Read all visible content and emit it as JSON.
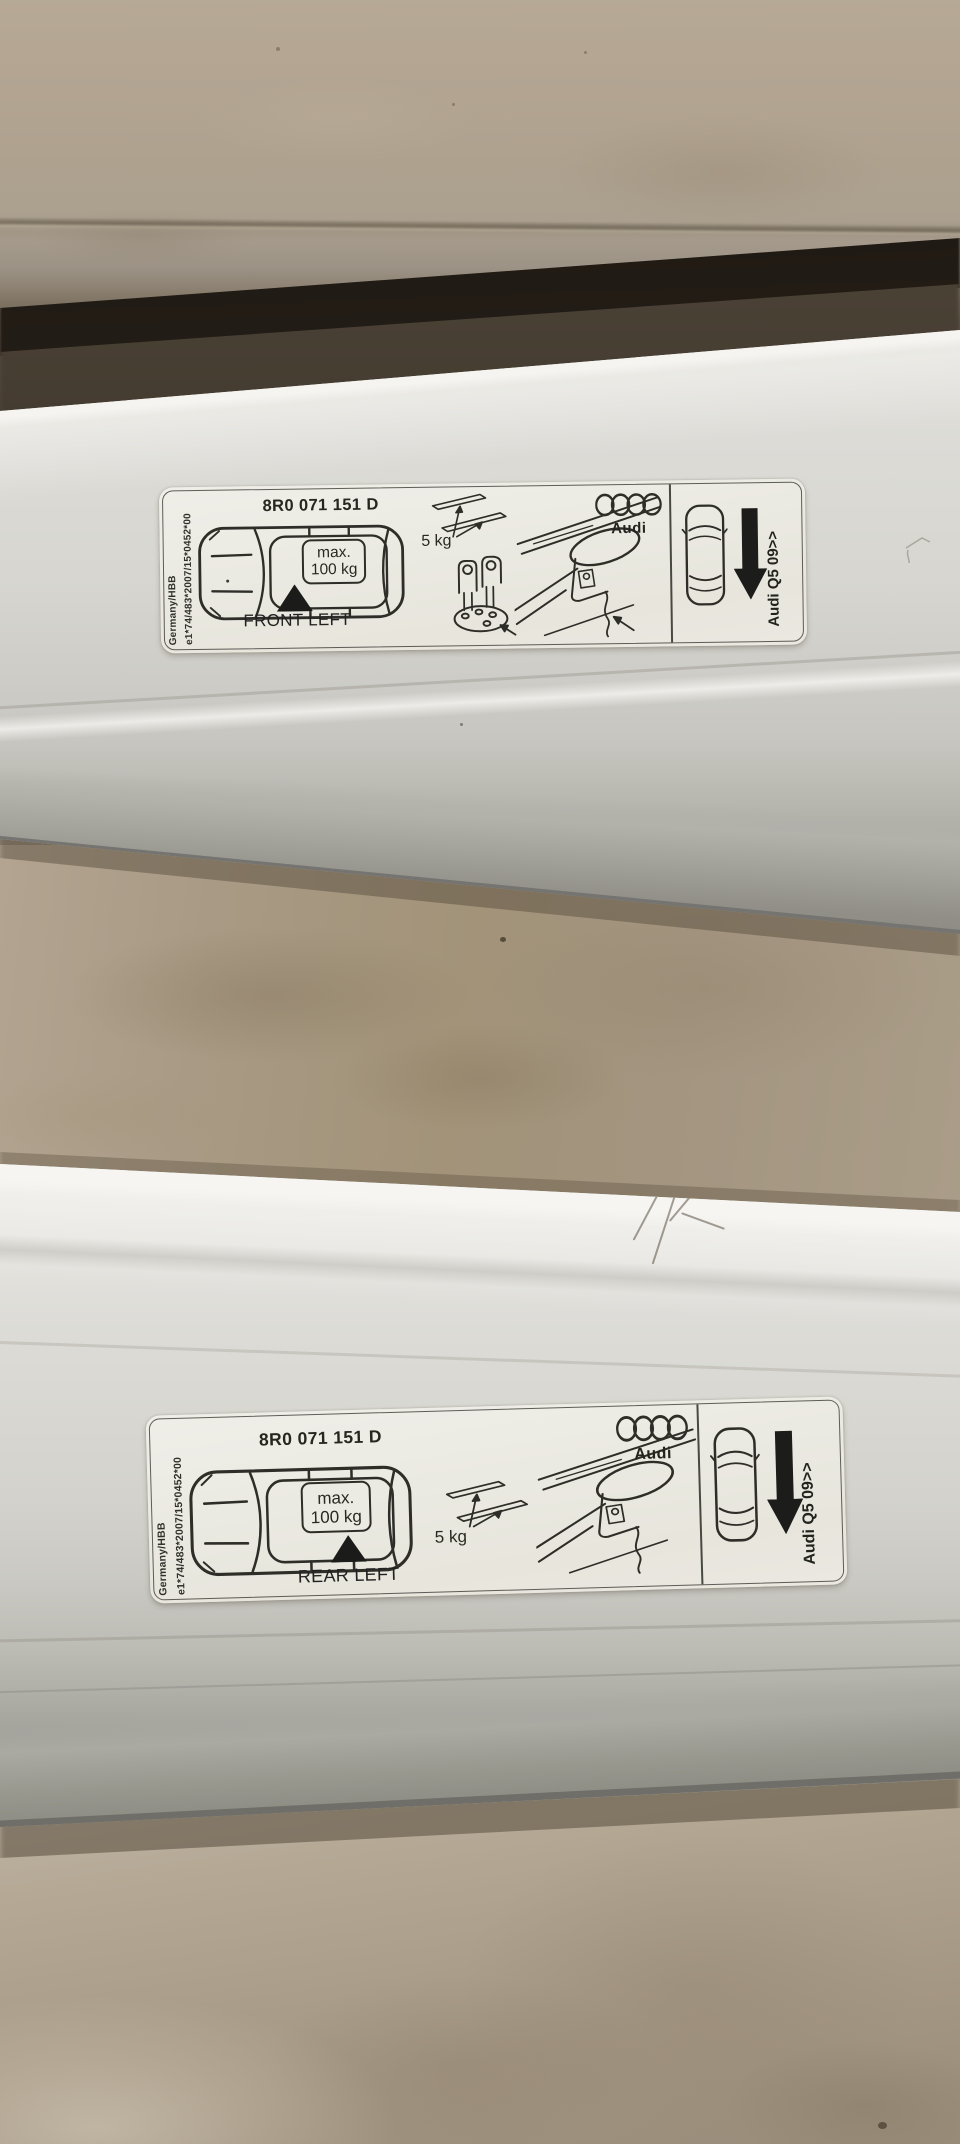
{
  "labels": [
    {
      "part_number": "8R0 071 151 D",
      "fitment_position": "FRONT LEFT",
      "max_load_line1": "max.",
      "max_load_line2": "100 kg",
      "accessory_weight": "5 kg",
      "brand_wordmark": "Audi",
      "vehicle_model": "Audi Q5 09>>",
      "homologation_line1": "Germany/HBB",
      "homologation_line2": "e1*74/483*2007/15*0452*00"
    },
    {
      "part_number": "8R0 071 151 D",
      "fitment_position": "REAR LEFT",
      "max_load_line1": "max.",
      "max_load_line2": "100 kg",
      "accessory_weight": "5 kg",
      "brand_wordmark": "Audi",
      "vehicle_model": "Audi Q5 09>>",
      "homologation_line1": "Germany/HBB",
      "homologation_line2": "e1*74/483*2007/15*0452*00"
    }
  ],
  "icons": {
    "audi_rings": "four-interlocked-circles",
    "direction_arrow": "solid-down-arrow",
    "position_marker": "solid-up-triangle",
    "car_top_view": "vehicle-outline-top-view"
  },
  "colors": {
    "label_background": "#ecebe3",
    "label_ink": "#2e2d28",
    "bar_silver": "#d8d7d1",
    "bar_highlight": "#f5f4f1",
    "bar_shadow_edge": "#757470",
    "floor_beige": "#a79a85",
    "floor_light": "#c2b9a8",
    "expansion_gap_dark": "#1f1913",
    "wall_beige": "#b3a592"
  }
}
